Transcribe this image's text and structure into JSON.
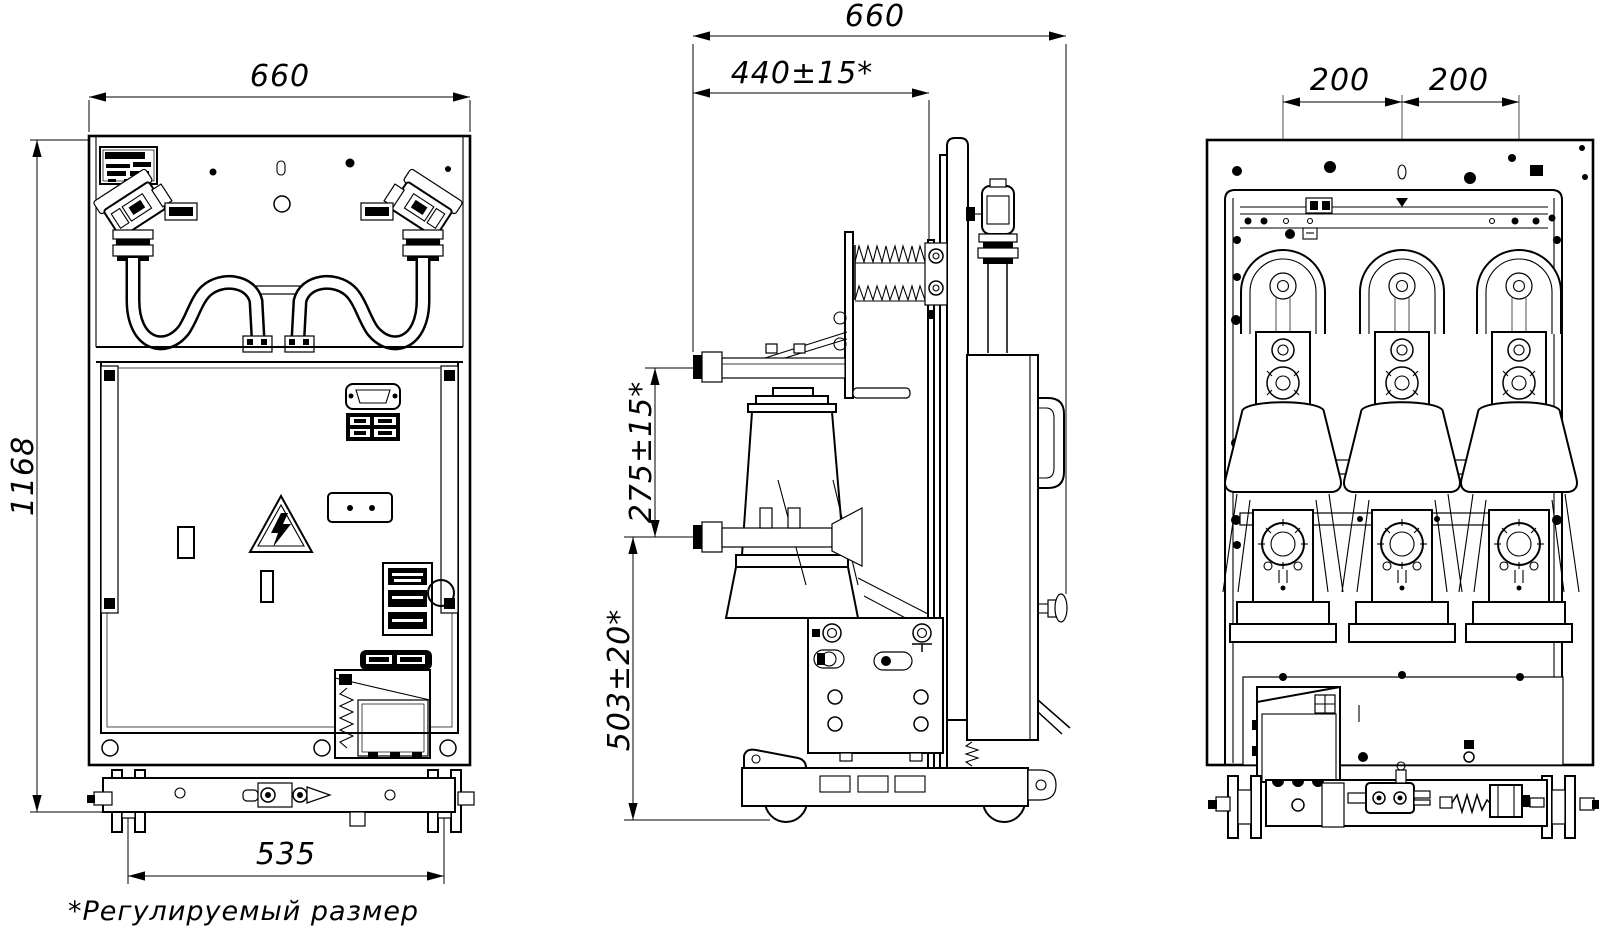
{
  "page": {
    "background": "#ffffff",
    "footnote": "*Регулируемый размер"
  },
  "dimensions": {
    "front_width": "660",
    "front_height": "1168",
    "front_wheel_track": "535",
    "side_depth": "660",
    "side_upper_contact_reach": "440±15*",
    "side_contact_pitch": "275±15*",
    "side_lower_contact_height": "503±20*",
    "rear_pole_pitch_left": "200",
    "rear_pole_pitch_right": "200"
  },
  "icons": {
    "warning_triangle": "high-voltage-warning-triangle",
    "nameplate": "manufacturer-nameplate",
    "connector_tags": "wiring-connector-labels"
  }
}
